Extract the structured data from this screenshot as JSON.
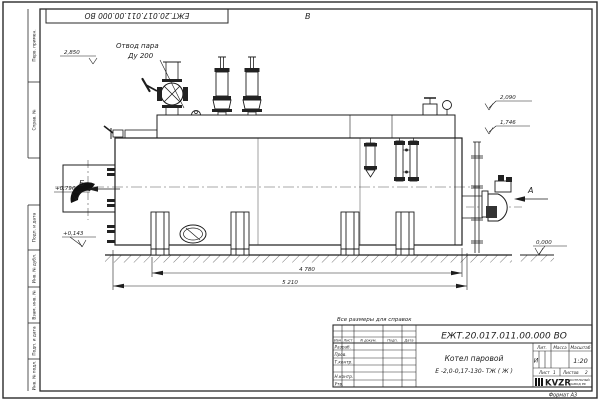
{
  "frame": {
    "stamp_number": "ЕЖТ.20.017.011.00.000 ВО",
    "format_label": "Формат А3",
    "margin_labels": [
      "Перв. примен.",
      "Справ. №",
      "Подп. и дата",
      "Инв. № дубл.",
      "Взам. инв. №",
      "Подп. и дата",
      "Инв. № подл."
    ]
  },
  "annotations": {
    "steam_outlet_line1": "Отвод пара",
    "steam_outlet_line2": "Ду 200",
    "elev_top_left": "2,850",
    "elev_right_1": "2,090",
    "elev_right_2": "1,746",
    "elev_left_1": "+0,796",
    "elev_left_2": "+0,143",
    "elev_ground": "0,000",
    "view_top": "В",
    "view_left": "Б",
    "view_right": "А",
    "dim_inner": "4 780",
    "dim_outer": "5 210",
    "reference_note": "Все размеры для справок"
  },
  "title_block": {
    "doc_number": "ЕЖТ.20.017.011.00.000  ВО",
    "product_line1": "Котел паровой",
    "product_line2": "Е -2,0-0,17-130- ТЖ ( Ж )",
    "header_cols": [
      "Изм",
      "Лист",
      "N докум.",
      "Подп.",
      "Дата"
    ],
    "row_labels": [
      "Разраб.",
      "Пров.",
      "Т.контр.",
      "Н.контр.",
      "Утв."
    ],
    "lit_label": "Лит.",
    "lit_value": "И",
    "mass_label": "Масса",
    "scale_label": "Масштаб",
    "scale_value": "1:20",
    "sheet_label": "Лист",
    "sheet_value": "1",
    "sheets_label": "Листов",
    "sheets_value": "2",
    "logo_text": "KVZR",
    "logo_caption_line1": "КОТЕЛЬНЫЙ",
    "logo_caption_line2": "ЗАВОД РФ"
  }
}
